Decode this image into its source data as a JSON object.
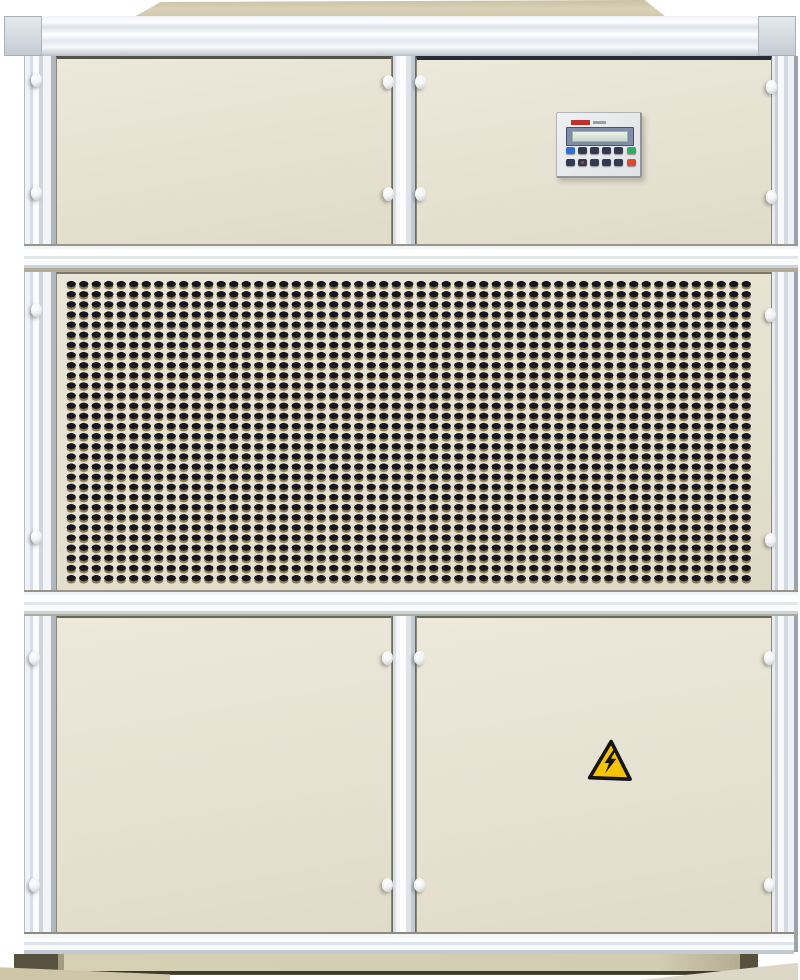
{
  "scene": {
    "type": "photograph",
    "subject": "industrial air-handling / dehumidifier cabinet unit",
    "background_color": "#ffffff"
  },
  "cabinet": {
    "body_color": "#e6e2d2",
    "frame_color": "#eef1f5",
    "lid_color": "#d9d2b7",
    "plinth_color": "#d2ccb0",
    "sections": [
      {
        "name": "upper-left-access-panel"
      },
      {
        "name": "upper-right-access-panel",
        "has_controller": true
      },
      {
        "name": "middle-ventilation-grille",
        "perforated": true
      },
      {
        "name": "lower-left-access-panel"
      },
      {
        "name": "lower-right-access-panel",
        "has_warning_sticker": true
      }
    ],
    "fastener_style": "white-oval-latch-pin",
    "fastener_count": 20
  },
  "grille": {
    "slot_color": "#15151d",
    "slot_highlight_color": "#8f7c52",
    "columns": 55,
    "rows": 30
  },
  "controller": {
    "logo_color": "#c03028",
    "display": {
      "type": "lcd",
      "bezel_color": "#7f8ea6",
      "screen_color": "#d4e3d6"
    },
    "keypad": {
      "rows": [
        [
          "blue",
          "navy",
          "navy",
          "navy",
          "navy",
          "green"
        ],
        [
          "navy",
          "navy-reddot",
          "navy",
          "navy",
          "navy",
          "red"
        ]
      ],
      "colors": {
        "blue": "#2f6fd0",
        "navy": "#333a4e",
        "navy-reddot": "#333a4e",
        "green": "#2fae62",
        "red": "#e0482a"
      }
    }
  },
  "warning_sticker": {
    "icon": "high-voltage-warning-triangle",
    "shape": "triangle",
    "fill_color": "#f5c400",
    "border_color": "#141414",
    "symbol": "lightning-bolt"
  }
}
